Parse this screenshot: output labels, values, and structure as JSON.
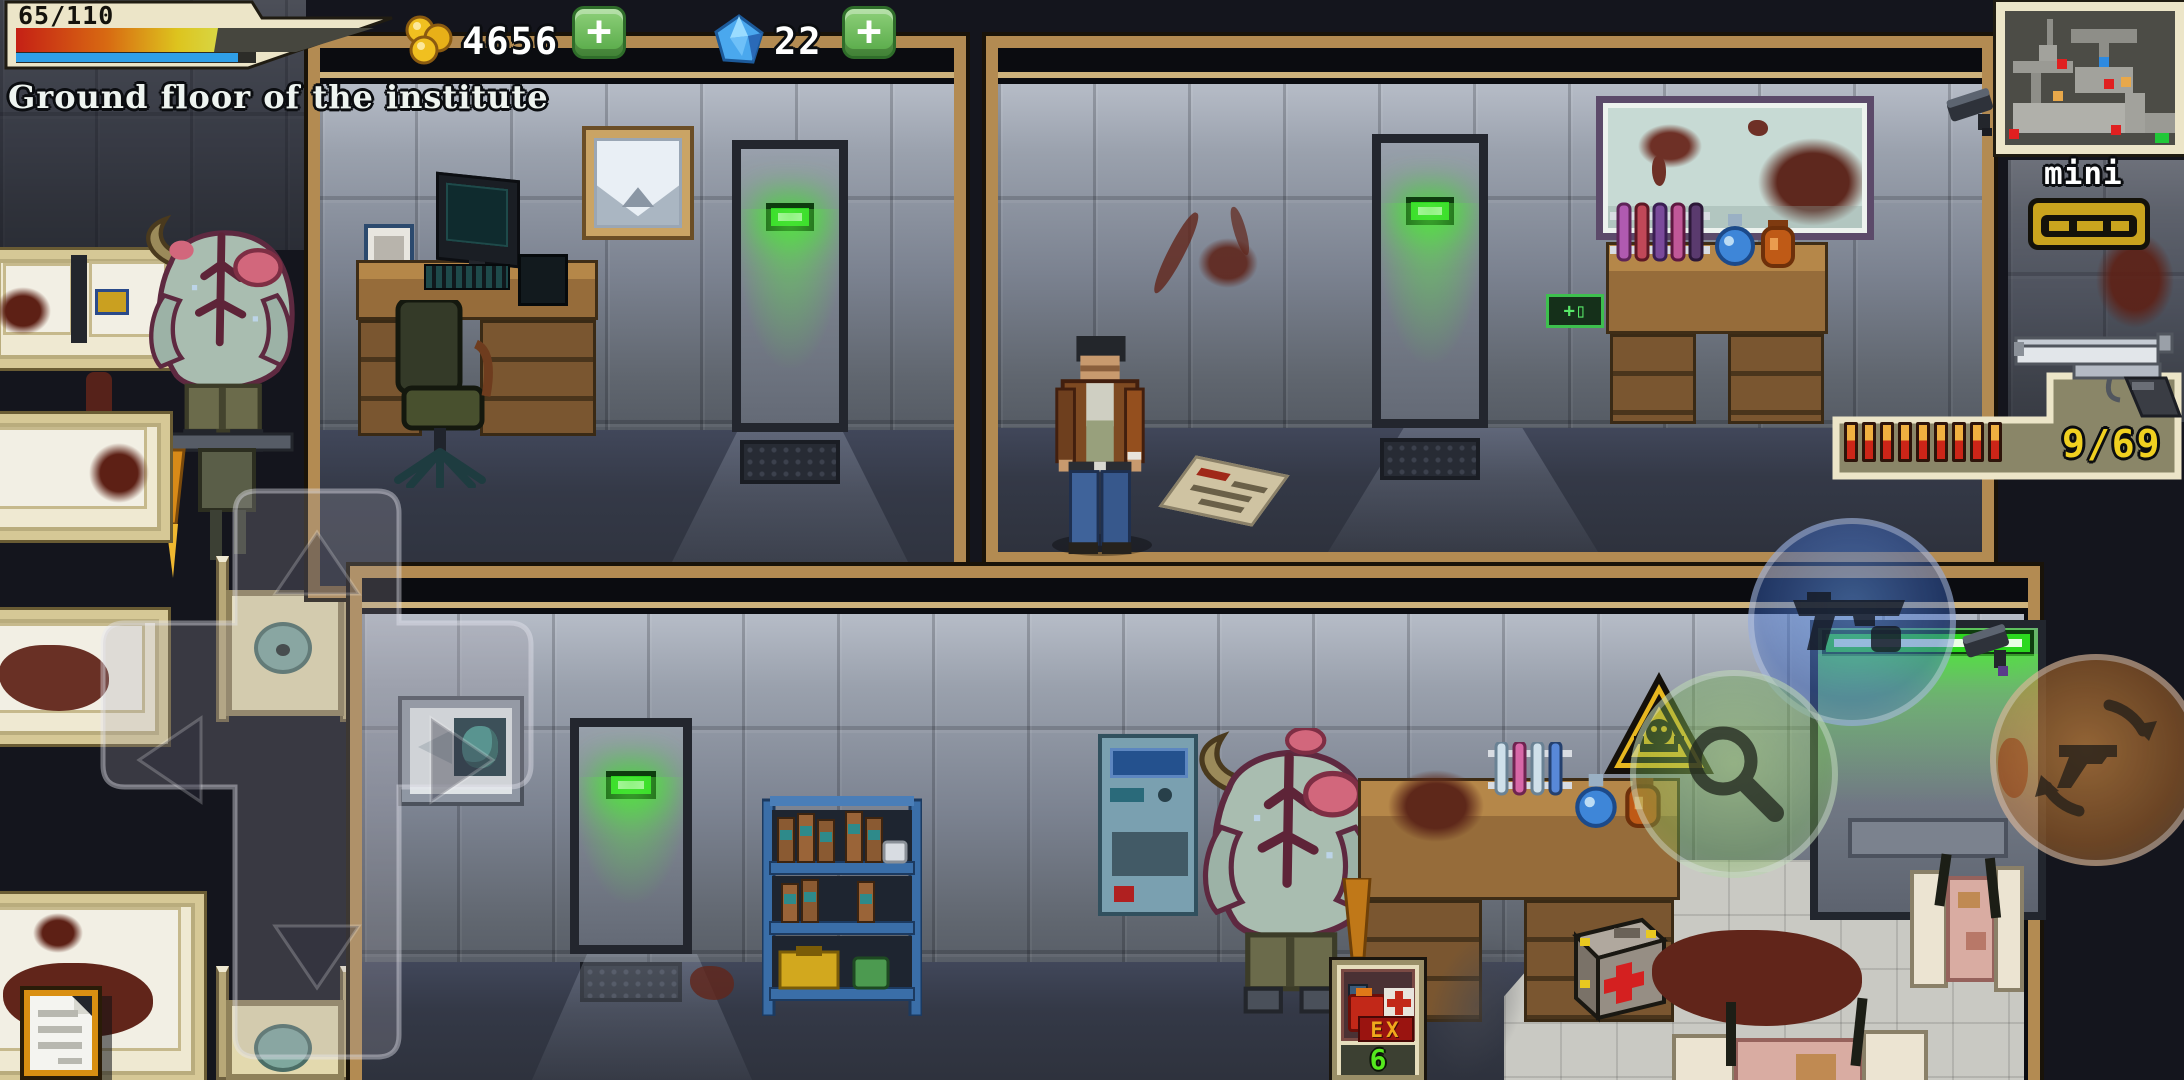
{
  "hud": {
    "health": {
      "display": "65/110",
      "fill_percent": 59,
      "stamina_percent": 92,
      "bar_gradient": [
        "#c52015",
        "#d86a12",
        "#ddc41e",
        "#d8d643"
      ],
      "stamina_color": "#2f9fe8"
    },
    "location_label": "Ground floor of the institute",
    "coins": {
      "value": "4656",
      "add_label": "+"
    },
    "gems": {
      "value": "22",
      "add_label": "+"
    },
    "minimap": {
      "label": "mini map",
      "dot_colors": {
        "enemy": "#e02020",
        "player": "#2e8ae0",
        "loot": "#e8a84a",
        "exit": "#20c838"
      }
    },
    "weapon": {
      "ammo_display": "9/69",
      "bullets_in_clip": 9,
      "ammo_color": "#f0d020"
    },
    "quick_item": {
      "tag": "EX",
      "count": "6",
      "count_color": "#55e81e"
    }
  }
}
